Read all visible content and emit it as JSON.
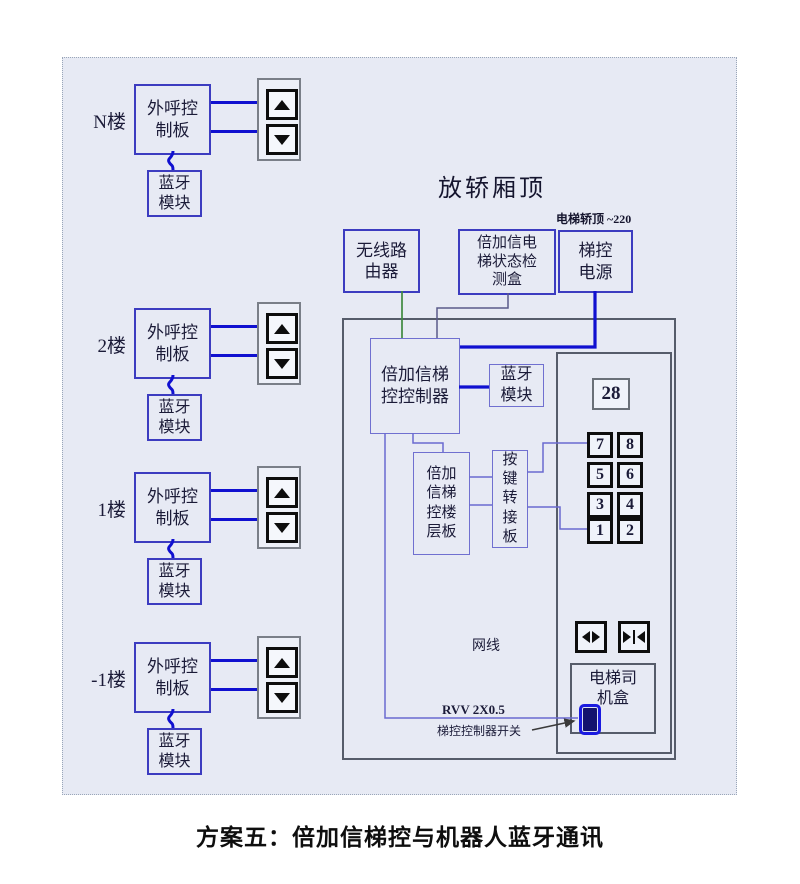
{
  "caption": "方案五：倍加信梯控与机器人蓝牙通讯",
  "floors": [
    {
      "label": "N楼"
    },
    {
      "label": "2楼"
    },
    {
      "label": "1楼"
    },
    {
      "label": "-1楼"
    }
  ],
  "call_board": {
    "line1": "外呼控",
    "line2": "制板"
  },
  "bluetooth_module": {
    "line1": "蓝牙",
    "line2": "模块"
  },
  "car_top": {
    "title": "放轿厢顶",
    "power_note": "电梯轿顶 ~220",
    "router": {
      "line1": "无线路",
      "line2": "由器"
    },
    "detector": {
      "line1": "倍加信电",
      "line2": "梯状态检",
      "line3": "测盒"
    },
    "power": {
      "line1": "梯控",
      "line2": "电源"
    }
  },
  "panel": {
    "controller": {
      "line1": "倍加信梯",
      "line2": "控控制器"
    },
    "bt": {
      "line1": "蓝牙",
      "line2": "模块"
    },
    "floor_board": {
      "line1": "倍加",
      "line2": "信梯",
      "line3": "控楼",
      "line4": "层板"
    },
    "key_adapter": {
      "l1": "按",
      "l2": "键",
      "l3": "转",
      "l4": "接",
      "l5": "板"
    },
    "display": "28",
    "button_labels": [
      "7",
      "8",
      "5",
      "6",
      "3",
      "4",
      "1",
      "2"
    ],
    "driver_box": {
      "line1": "电梯司",
      "line2": "机盒"
    },
    "labels": {
      "net": "网线",
      "rvv": "RVV 2X0.5",
      "switch": "梯控控制器开关"
    }
  },
  "colors": {
    "diagram_bg": "#e7eaf4",
    "device_border_blue": "#3c3cc0",
    "thick_wire_blue": "#1010d0",
    "thin_wire_purple": "#6a6ad0",
    "green_wire": "#3f8a3f",
    "panel_border_gray": "#565c6a",
    "switch_blue": "#1a1ae0"
  }
}
